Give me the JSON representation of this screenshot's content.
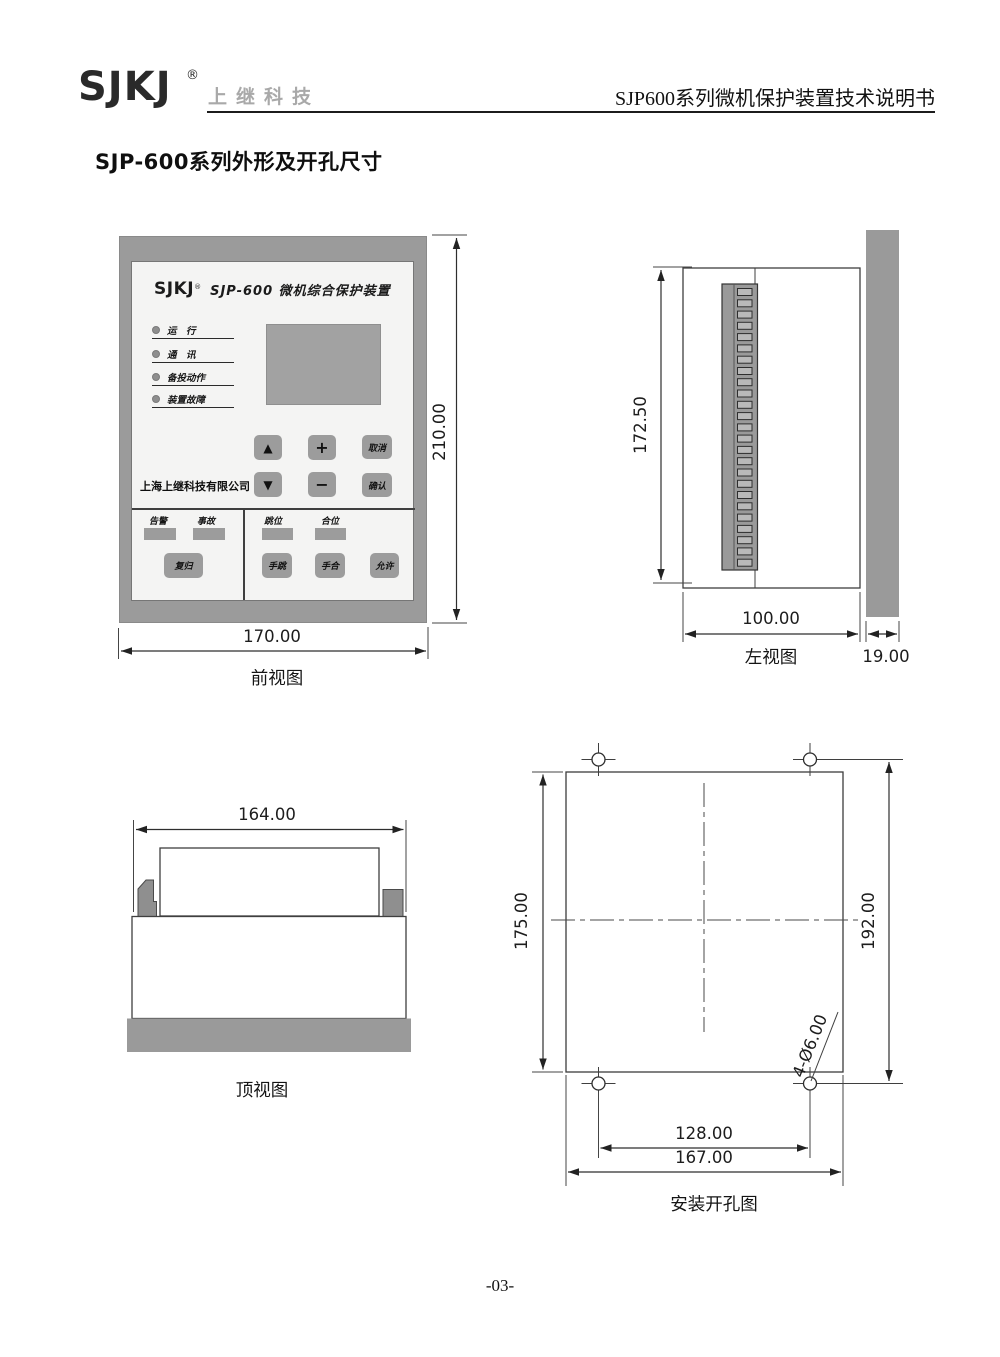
{
  "header": {
    "logo": "SJKJ",
    "reg_mark": "®",
    "brand_cn": "上继科技",
    "doc_title": "SJP600系列微机保护装置技术说明书"
  },
  "section_title": "SJP-600系列外形及开孔尺寸",
  "front_view": {
    "caption": "前视图",
    "dim_height": "210.00",
    "dim_width": "170.00",
    "device": {
      "logo": "SJKJ",
      "reg_mark": "®",
      "title": "SJP-600 微机综合保护装置",
      "led_run": "运　行",
      "led_comm": "通　讯",
      "led_action": "备投动作",
      "led_fault": "装置故障",
      "company": "上海上继科技有限公司",
      "key_up": "▲",
      "key_plus": "+",
      "key_cancel": "取消",
      "key_down": "▼",
      "key_minus": "−",
      "key_confirm": "确认",
      "label_alarm": "告警",
      "label_event": "事故",
      "key_reset": "复归",
      "label_open": "跳位",
      "label_close": "合位",
      "key_manual_trip": "手跳",
      "key_manual_close": "手合",
      "key_permit": "允许"
    }
  },
  "left_view": {
    "caption": "左视图",
    "dim_height": "172.50",
    "dim_depth": "100.00",
    "dim_panel": "19.00"
  },
  "top_view": {
    "caption": "顶视图",
    "dim_width": "164.00"
  },
  "mount_view": {
    "caption": "安装开孔图",
    "dim_cutout_height": "175.00",
    "dim_hole_v": "192.00",
    "dim_hole_h": "128.00",
    "dim_cutout_width": "167.00",
    "hole_note": "4-Ø6.00"
  },
  "footer": {
    "page_number": "-03-"
  }
}
